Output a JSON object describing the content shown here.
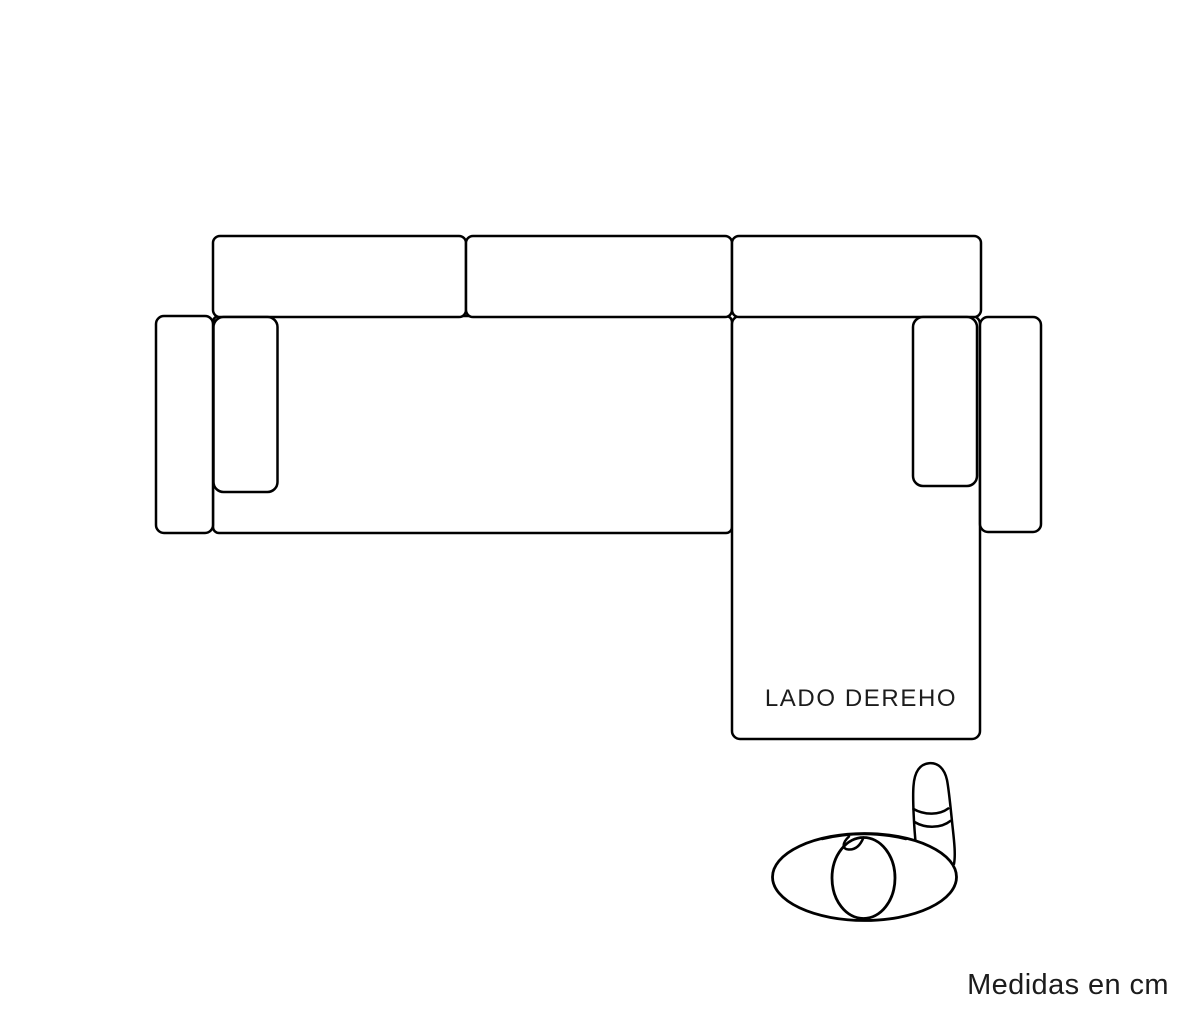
{
  "canvas": {
    "background": "#ffffff",
    "line_color": "#000000",
    "text_color": "#1c1c1c"
  },
  "diagram": {
    "kind": "sofa-chaise-top-view",
    "side_label": "LADO DEREHO",
    "units_label": "Medidas en cm",
    "icons": {
      "person": "person-top-view-icon"
    }
  }
}
